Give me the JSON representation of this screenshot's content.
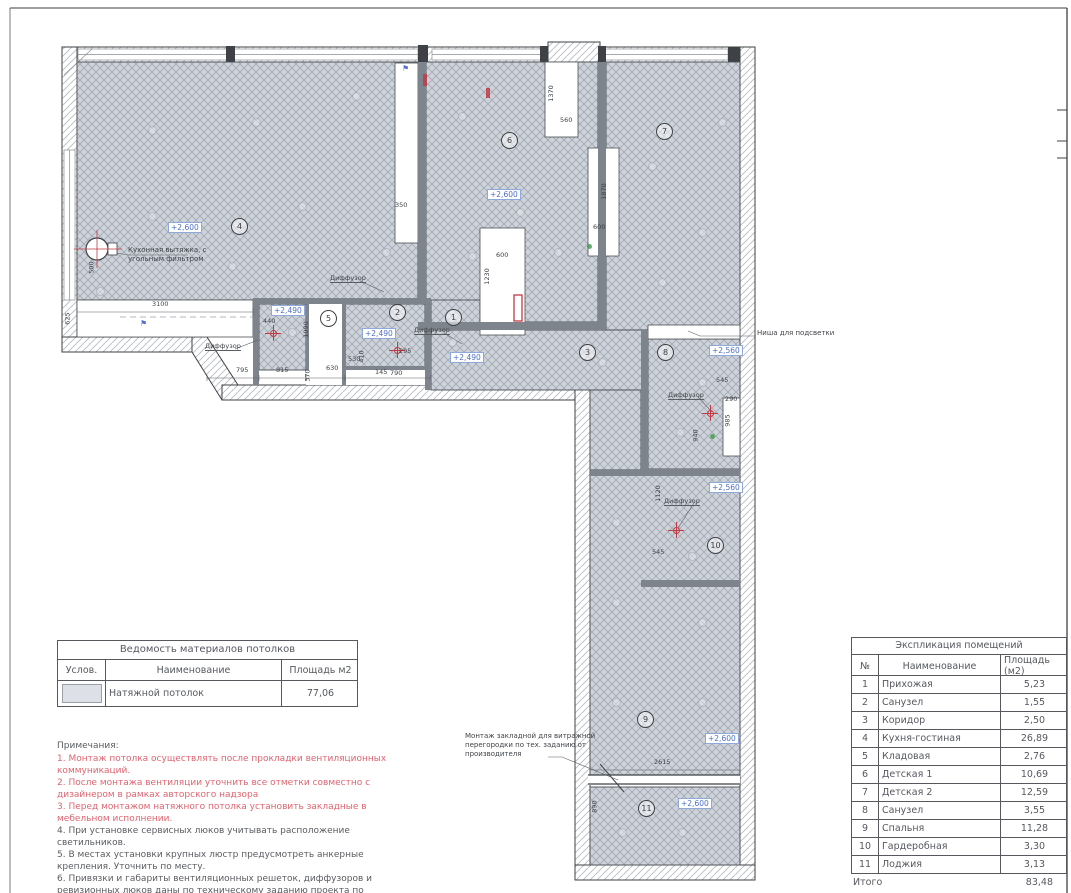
{
  "plan": {
    "height_labels": [
      {
        "text": "+2,600",
        "x": 168,
        "y": 222
      },
      {
        "text": "+2,600",
        "x": 487,
        "y": 189
      },
      {
        "text": "+2,490",
        "x": 271,
        "y": 305
      },
      {
        "text": "+2,490",
        "x": 362,
        "y": 328
      },
      {
        "text": "+2,490",
        "x": 450,
        "y": 352
      },
      {
        "text": "+2,560",
        "x": 709,
        "y": 345
      },
      {
        "text": "+2,560",
        "x": 709,
        "y": 482
      },
      {
        "text": "+2,600",
        "x": 705,
        "y": 733
      },
      {
        "text": "+2,600",
        "x": 678,
        "y": 798
      }
    ],
    "room_circles": [
      {
        "num": "4",
        "x": 231,
        "y": 218
      },
      {
        "num": "6",
        "x": 501,
        "y": 132
      },
      {
        "num": "7",
        "x": 656,
        "y": 123
      },
      {
        "num": "5",
        "x": 320,
        "y": 310
      },
      {
        "num": "2",
        "x": 389,
        "y": 304
      },
      {
        "num": "1",
        "x": 445,
        "y": 309
      },
      {
        "num": "3",
        "x": 579,
        "y": 344
      },
      {
        "num": "8",
        "x": 657,
        "y": 344
      },
      {
        "num": "10",
        "x": 707,
        "y": 537
      },
      {
        "num": "9",
        "x": 637,
        "y": 711
      },
      {
        "num": "11",
        "x": 638,
        "y": 800
      }
    ],
    "dims": [
      {
        "text": "3100",
        "x": 152,
        "y": 301
      },
      {
        "text": "625",
        "x": 62,
        "y": 315,
        "rot": -90
      },
      {
        "text": "500",
        "x": 86,
        "y": 264,
        "rot": -90
      },
      {
        "text": "350",
        "x": 395,
        "y": 202
      },
      {
        "text": "1370",
        "x": 543,
        "y": 90,
        "rot": -90
      },
      {
        "text": "560",
        "x": 560,
        "y": 117
      },
      {
        "text": "1870",
        "x": 596,
        "y": 188,
        "rot": -90
      },
      {
        "text": "600",
        "x": 593,
        "y": 224
      },
      {
        "text": "600",
        "x": 496,
        "y": 252
      },
      {
        "text": "1230",
        "x": 479,
        "y": 273,
        "rot": -90
      },
      {
        "text": "795",
        "x": 236,
        "y": 367
      },
      {
        "text": "815",
        "x": 276,
        "y": 367
      },
      {
        "text": "630",
        "x": 326,
        "y": 365
      },
      {
        "text": "370",
        "x": 302,
        "y": 372,
        "rot": -90
      },
      {
        "text": "530",
        "x": 348,
        "y": 356
      },
      {
        "text": "410",
        "x": 356,
        "y": 353,
        "rot": -90
      },
      {
        "text": "145",
        "x": 375,
        "y": 369
      },
      {
        "text": "790",
        "x": 390,
        "y": 370
      },
      {
        "text": "295",
        "x": 399,
        "y": 348
      },
      {
        "text": "1090",
        "x": 298,
        "y": 326,
        "rot": -90
      },
      {
        "text": "440",
        "x": 263,
        "y": 318
      },
      {
        "text": "545",
        "x": 716,
        "y": 377
      },
      {
        "text": "290",
        "x": 725,
        "y": 396
      },
      {
        "text": "985",
        "x": 722,
        "y": 417,
        "rot": -90
      },
      {
        "text": "940",
        "x": 690,
        "y": 432,
        "rot": -90
      },
      {
        "text": "545",
        "x": 652,
        "y": 549
      },
      {
        "text": "1120",
        "x": 650,
        "y": 490,
        "rot": -90
      },
      {
        "text": "2615",
        "x": 654,
        "y": 759
      },
      {
        "text": "890",
        "x": 589,
        "y": 803,
        "rot": -90
      }
    ],
    "diffusers": [
      {
        "text": "Диффузор",
        "x": 205,
        "y": 342
      },
      {
        "text": "Диффузор",
        "x": 414,
        "y": 326
      },
      {
        "text": "Диффузор",
        "x": 330,
        "y": 274
      },
      {
        "text": "Диффузор",
        "x": 668,
        "y": 391
      },
      {
        "text": "Диффузор",
        "x": 664,
        "y": 497
      }
    ],
    "annotations": [
      {
        "text": "Кухонная вытяжка, с\nугольным фильтром",
        "x": 128,
        "y": 246
      },
      {
        "text": "Ниша для подсветки",
        "x": 757,
        "y": 329
      },
      {
        "text": "Монтаж закладной для витражной\nперегородки по тех. заданию от\nпроизводителя",
        "x": 465,
        "y": 732
      }
    ],
    "lights": [
      {
        "x": 148,
        "y": 126
      },
      {
        "x": 252,
        "y": 118
      },
      {
        "x": 352,
        "y": 92
      },
      {
        "x": 148,
        "y": 212
      },
      {
        "x": 298,
        "y": 202
      },
      {
        "x": 382,
        "y": 248
      },
      {
        "x": 228,
        "y": 262
      },
      {
        "x": 96,
        "y": 287
      },
      {
        "x": 458,
        "y": 112
      },
      {
        "x": 516,
        "y": 208
      },
      {
        "x": 468,
        "y": 252
      },
      {
        "x": 554,
        "y": 248
      },
      {
        "x": 648,
        "y": 162
      },
      {
        "x": 698,
        "y": 228
      },
      {
        "x": 658,
        "y": 278
      },
      {
        "x": 718,
        "y": 118
      },
      {
        "x": 448,
        "y": 338
      },
      {
        "x": 598,
        "y": 358
      },
      {
        "x": 676,
        "y": 428
      },
      {
        "x": 698,
        "y": 378
      },
      {
        "x": 688,
        "y": 552
      },
      {
        "x": 612,
        "y": 598
      },
      {
        "x": 698,
        "y": 618
      },
      {
        "x": 612,
        "y": 698
      },
      {
        "x": 698,
        "y": 698
      },
      {
        "x": 612,
        "y": 518
      },
      {
        "x": 618,
        "y": 828
      },
      {
        "x": 678,
        "y": 828
      },
      {
        "x": 288,
        "y": 328
      },
      {
        "x": 378,
        "y": 328
      }
    ],
    "vent_marks": [
      {
        "x": 265,
        "y": 325
      },
      {
        "x": 389,
        "y": 342
      },
      {
        "x": 702,
        "y": 405
      },
      {
        "x": 668,
        "y": 522
      }
    ],
    "sprinkler_marks": [
      {
        "symbol": "⚑",
        "x": 140,
        "y": 320
      },
      {
        "symbol": "⚑",
        "x": 402,
        "y": 65
      }
    ],
    "sensor_marks": [
      {
        "x": 710,
        "y": 434
      },
      {
        "x": 587,
        "y": 244
      }
    ]
  },
  "materials_table": {
    "title": "Ведомость материалов потолков",
    "headers": [
      "Услов.",
      "Наименование",
      "Площадь м2"
    ],
    "rows": [
      {
        "name": "Натяжной потолок",
        "area": "77,06"
      }
    ]
  },
  "explication_table": {
    "title": "Экспликация помещений",
    "headers": [
      "№",
      "Наименование",
      "Площадь (м2)"
    ],
    "rows": [
      {
        "num": "1",
        "name": "Прихожая",
        "area": "5,23"
      },
      {
        "num": "2",
        "name": "Санузел",
        "area": "1,55"
      },
      {
        "num": "3",
        "name": "Коридор",
        "area": "2,50"
      },
      {
        "num": "4",
        "name": "Кухня-гостиная",
        "area": "26,89"
      },
      {
        "num": "5",
        "name": "Кладовая",
        "area": "2,76"
      },
      {
        "num": "6",
        "name": "Детская 1",
        "area": "10,69"
      },
      {
        "num": "7",
        "name": "Детская 2",
        "area": "12,59"
      },
      {
        "num": "8",
        "name": "Санузел",
        "area": "3,55"
      },
      {
        "num": "9",
        "name": "Спальня",
        "area": "11,28"
      },
      {
        "num": "10",
        "name": "Гардеробная",
        "area": "3,30"
      },
      {
        "num": "11",
        "name": "Лоджия",
        "area": "3,13"
      }
    ],
    "total_label": "Итого",
    "total_value": "83,48"
  },
  "notes": {
    "title": "Примечания:",
    "items": [
      {
        "text": "1. Монтаж потолка осуществлять после прокладки вентиляционных коммуникаций.",
        "color": "#dd6570"
      },
      {
        "text": "2. После монтажа вентиляции уточнить все отметки совместно с дизайнером в рамках авторского надзора",
        "color": "#dd6570"
      },
      {
        "text": "3. Перед монтажом натяжного потолка установить закладные в мебельном исполнении.",
        "color": "#dd6570"
      },
      {
        "text": "4. При установке сервисных люков учитывать расположение светильников.",
        "color": "#595d61"
      },
      {
        "text": "5. В местах установки крупных люстр предусмотреть анкерные крепления. Уточнить по месту.",
        "color": "#595d61"
      },
      {
        "text": "6. Привязки и габариты вентиляционных решеток, диффузоров и ревизионных люков даны по техническому заданию проекта по вентиляции.",
        "color": "#595d61"
      }
    ]
  },
  "colors": {
    "ceiling_hatch_bg": "#ced3da",
    "ceiling_hatch_line": "#9aa2ad",
    "wall_fill": "#7e848c",
    "outline": "#3e4246",
    "height_label_blue": "#4d6fc0",
    "note_red": "#dd6570",
    "vent_red": "#c03a44"
  }
}
